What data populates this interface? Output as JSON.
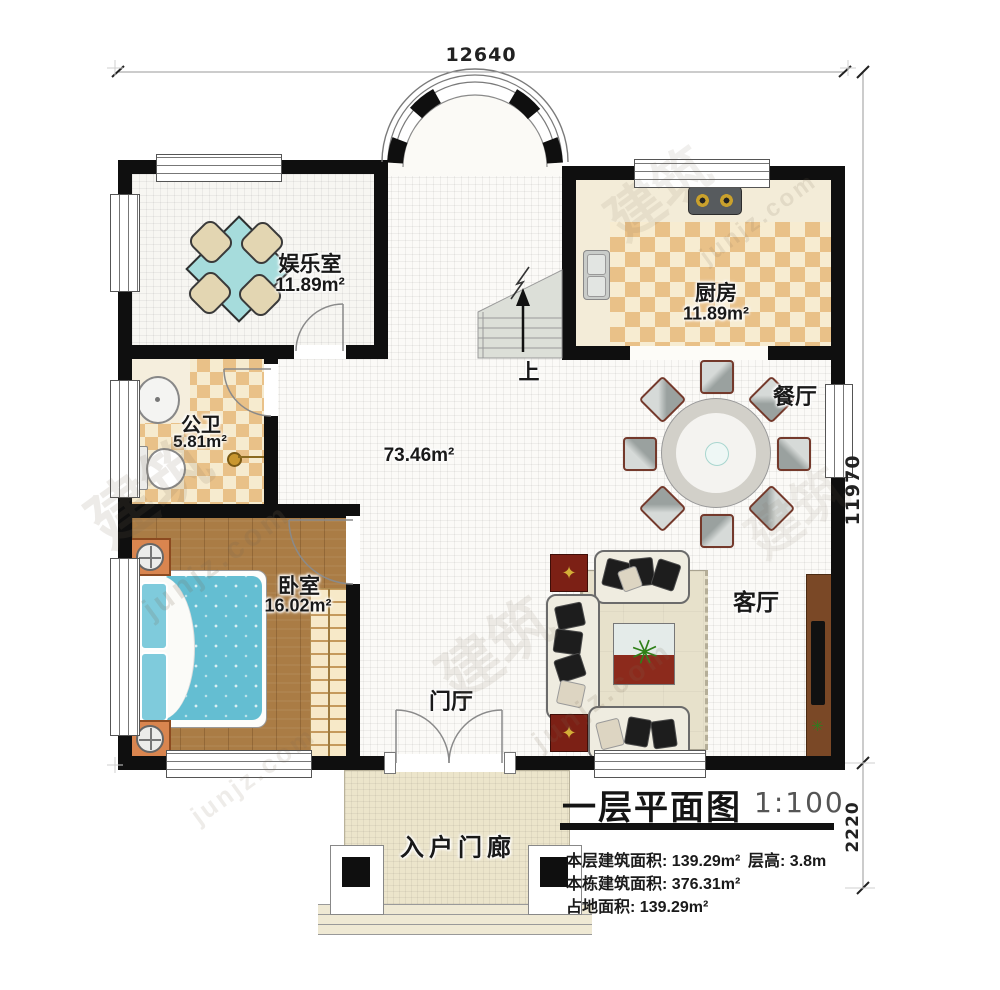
{
  "plan": {
    "dim_top": "12640",
    "dim_right": "11970",
    "dim_porch": "2220",
    "stairs_up_label": "上",
    "hall_area": "73.46m²"
  },
  "rooms": {
    "entertainment": {
      "name": "娱乐室",
      "area": "11.89m²"
    },
    "kitchen": {
      "name": "厨房",
      "area": "11.89m²"
    },
    "bathroom": {
      "name": "公卫",
      "area": "5.81m²"
    },
    "bedroom": {
      "name": "卧室",
      "area": "16.02m²"
    },
    "dining": {
      "name": "餐厅"
    },
    "living": {
      "name": "客厅"
    },
    "foyer": {
      "name": "门厅"
    },
    "porch": {
      "name": "入户门廊"
    }
  },
  "title_block": {
    "title": "一层平面图",
    "scale": "1:100",
    "floor_area_label": "本层建筑面积:",
    "floor_area_value": "139.29m²",
    "story_height_label": "层高:",
    "story_height_value": "3.8m",
    "building_area_label": "本栋建筑面积:",
    "building_area_value": "376.31m²",
    "footprint_label": "占地面积:",
    "footprint_value": "139.29m²"
  },
  "watermark": {
    "cn": "建筑",
    "domain": "junjz.com"
  },
  "colors": {
    "wall": "#0f0f0f",
    "checker": "#e9c188",
    "wood": "#aa7c45",
    "bed": "#64bed2",
    "table": "#a6dcdc"
  }
}
